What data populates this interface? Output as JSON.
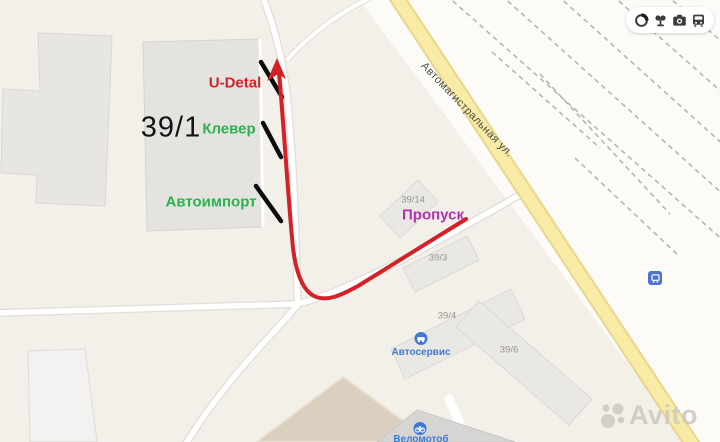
{
  "map_annotations": {
    "u_detal": "U-Detal",
    "building_number_main": "39/1",
    "klever": "Клевер",
    "avtoimport": "Автоимпорт",
    "propusk": "Пропуск"
  },
  "map_labels": {
    "street_name": "Автомагистральная ул.",
    "building_39_14": "39/14",
    "building_39_3": "39/3",
    "building_39_4": "39/4",
    "building_39_6": "39/6",
    "autoservice": "Автосервис",
    "velomoto": "Веломотоб"
  },
  "controls": {
    "icons": [
      "traffic-circle-icon",
      "panoramas-icon",
      "camera-icon",
      "transit-bus-icon"
    ]
  },
  "watermark": {
    "brand": "Avito"
  },
  "colors": {
    "annotation_red": "#d42127",
    "annotation_green": "#2bb150",
    "annotation_magenta": "#b52fb0",
    "poi_blue": "#3f7ad0",
    "road_yellow": "#f8eba6",
    "background": "#f3f0ea"
  }
}
